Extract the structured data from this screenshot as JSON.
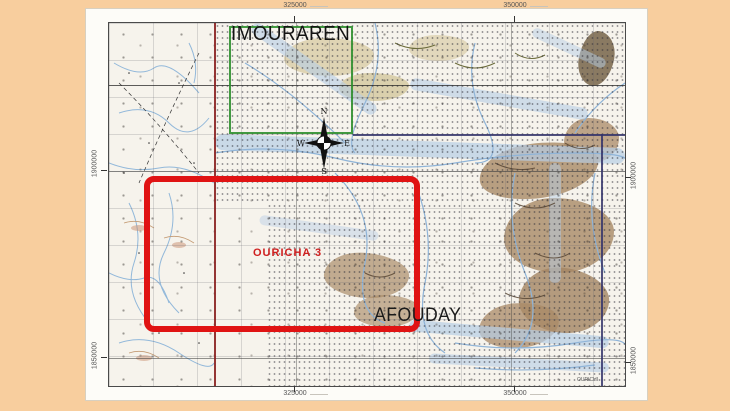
{
  "slide": {
    "background_color": "#F8CE9E",
    "description": "Topographic map extract showing the OURICHA 3 permit area near IMOURAREN and AFOUDAY"
  },
  "map_labels": {
    "imouraren": "IMOURAREN",
    "ouricha_permit": "OURICHA 3",
    "afouday": "AFOUDAY",
    "corner_note": "OURICHI"
  },
  "coordinates": {
    "top": [
      "325000",
      "350000"
    ],
    "bottom": [
      "325000",
      "350000"
    ],
    "left": [
      "1900000",
      "1850000"
    ],
    "right": [
      "1900000",
      "1850000"
    ]
  },
  "compass": {
    "n": "N",
    "e": "E",
    "s": "S",
    "w": "W"
  },
  "colors": {
    "permit_outline_red": "#E01313",
    "imouraren_outline_green": "#2F8F2F",
    "boundary_maroon": "#8A2020",
    "boundary_navy": "#32326A",
    "terrain_brown": "#A98A67",
    "water_blue": "#B6CDE6",
    "sheet_white": "#FDFCF8"
  }
}
